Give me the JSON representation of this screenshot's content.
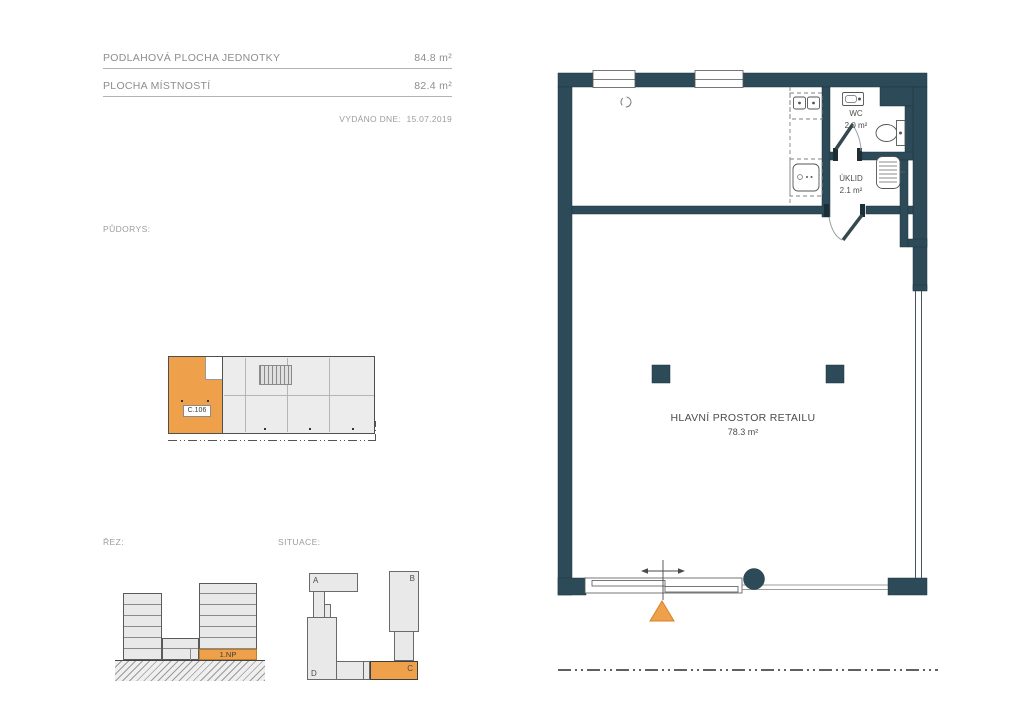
{
  "header": {
    "rows": [
      {
        "label": "PODLAHOVÁ PLOCHA JEDNOTKY",
        "value": "84.8 m²"
      },
      {
        "label": "PLOCHA MÍSTNOSTÍ",
        "value": "82.4 m²"
      }
    ],
    "issued": "VYDÁNO DNE:",
    "issued_date": "15.07.2019"
  },
  "labels": {
    "pudorys": "PŮDORYS:",
    "rez": "ŘEZ:",
    "situace": "SITUACE:"
  },
  "thumbnail": {
    "unit": "C.106"
  },
  "rez": {
    "floor": "1.NP"
  },
  "situace": {
    "block_a": "A",
    "block_b": "B",
    "block_c": "C",
    "block_d": "D",
    "highlighted": "C"
  },
  "plan": {
    "wc_name": "WC",
    "wc_area": "2.0 m²",
    "uklid_name": "ÚKLID",
    "uklid_area": "2.1 m²",
    "main_name": "HLAVNÍ PROSTOR RETAILU",
    "main_area": "78.3 m²"
  },
  "colors": {
    "orange": "#EFA04A",
    "wall": "#2C4A57"
  }
}
